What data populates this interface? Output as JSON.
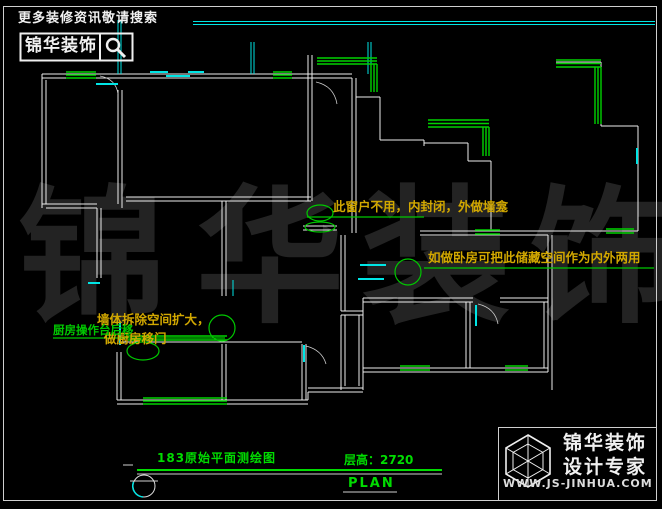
{
  "header": {
    "search_hint": "更多装修资讯敬请搜索",
    "brand": "锦华装饰",
    "search_icon": "magnifier"
  },
  "annotations": {
    "window_note": "此窗户不用，内封闭，外做墙龛",
    "storage_note": "如做卧房可把此储藏空间作为内外两用",
    "wall_note_line1": "墙体拆除空间扩大，",
    "wall_note_line2": "做厨房移门",
    "kitchen_note": "厨房操作台后移"
  },
  "title_block": {
    "drawing_title": "183原始平面测绘图",
    "floor_height": "层高：2720",
    "plan_label": "PLAN"
  },
  "footer_logo": {
    "brand_line1": "锦华装饰",
    "brand_line2": "设计专家",
    "website": "WWW.JS-JINHUA.COM",
    "logo_icon": "wireframe-cube"
  },
  "watermark": {
    "char1": "锦",
    "char2": "华",
    "char3": "装",
    "char4": "饰"
  },
  "colors": {
    "background": "#000000",
    "walls": "#ededed",
    "windows_cyan": "#00e5e5",
    "windows_green": "#00d200",
    "annotation_yellow": "#d2a800",
    "annotation_green": "#00c800",
    "title_green": "#00dc00",
    "watermark": "#232323"
  }
}
